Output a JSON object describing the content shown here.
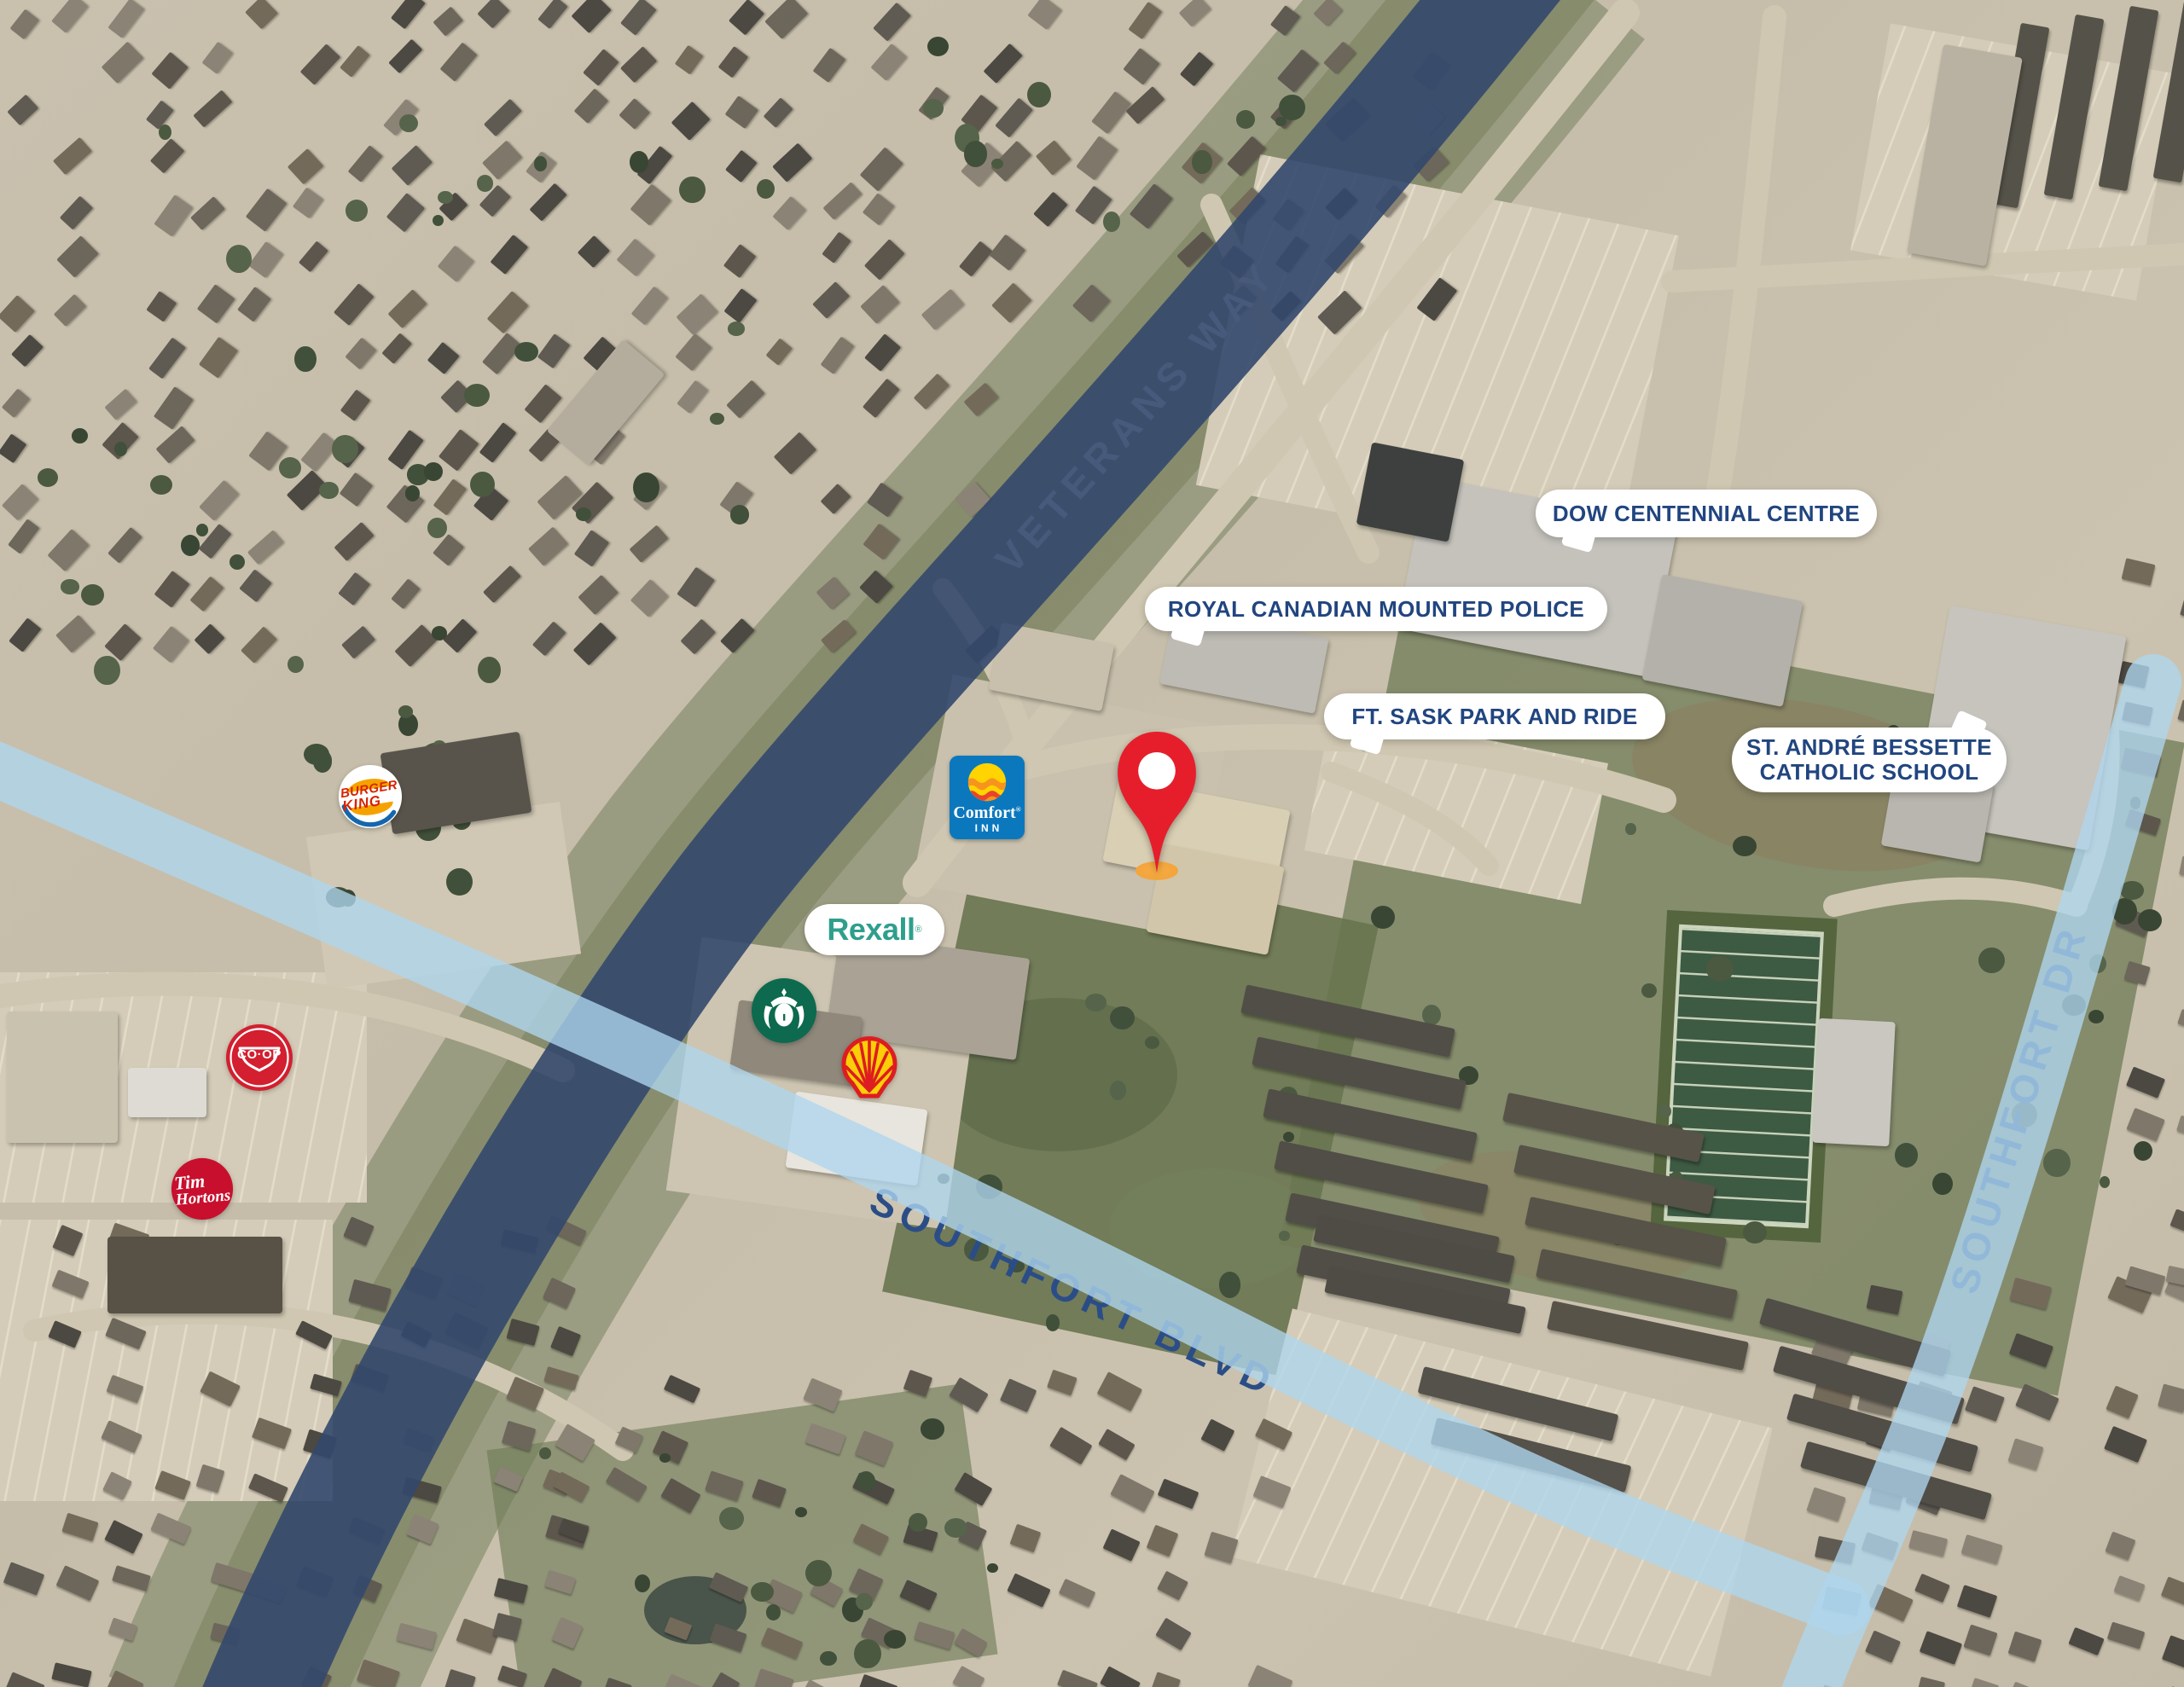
{
  "map": {
    "road_labels": {
      "veterans_way": "VETERANS WAY",
      "southfort_blvd": "SOUTHFORT BLVD",
      "southfort_dr": "SOUTHFORT DR"
    },
    "callouts": {
      "dow_centennial_centre": "DOW CENTENNIAL CENTRE",
      "royal_canadian_mounted_police": "ROYAL CANADIAN MOUNTED POLICE",
      "ft_sask_park_and_ride": "FT. SASK PARK AND RIDE",
      "st_andre_bessette_line1": "ST. ANDRÉ BESSETTE",
      "st_andre_bessette_line2": "CATHOLIC SCHOOL"
    },
    "brand_markers": {
      "burger_king_line1": "BURGER",
      "burger_king_line2": "KING",
      "coop": "CO·OP",
      "tim_hortons_line1": "Tim",
      "tim_hortons_line2": "Hortons",
      "comfort_inn_line1": "Comfort",
      "comfort_inn_reg": "®",
      "comfort_inn_line2": "INN",
      "rexall": "Rexall",
      "rexall_reg": "®",
      "starbucks_icon": "starbucks-siren-logo",
      "shell_icon": "shell-pecten-logo"
    },
    "pin": {
      "icon": "location-pin"
    },
    "colors": {
      "veterans_way_road": "#33486D",
      "southfort_road": "#B6D8EB",
      "callout_text": "#21457F",
      "pin_red": "#E61E2B",
      "pin_base_orange": "#F3A53C"
    }
  }
}
